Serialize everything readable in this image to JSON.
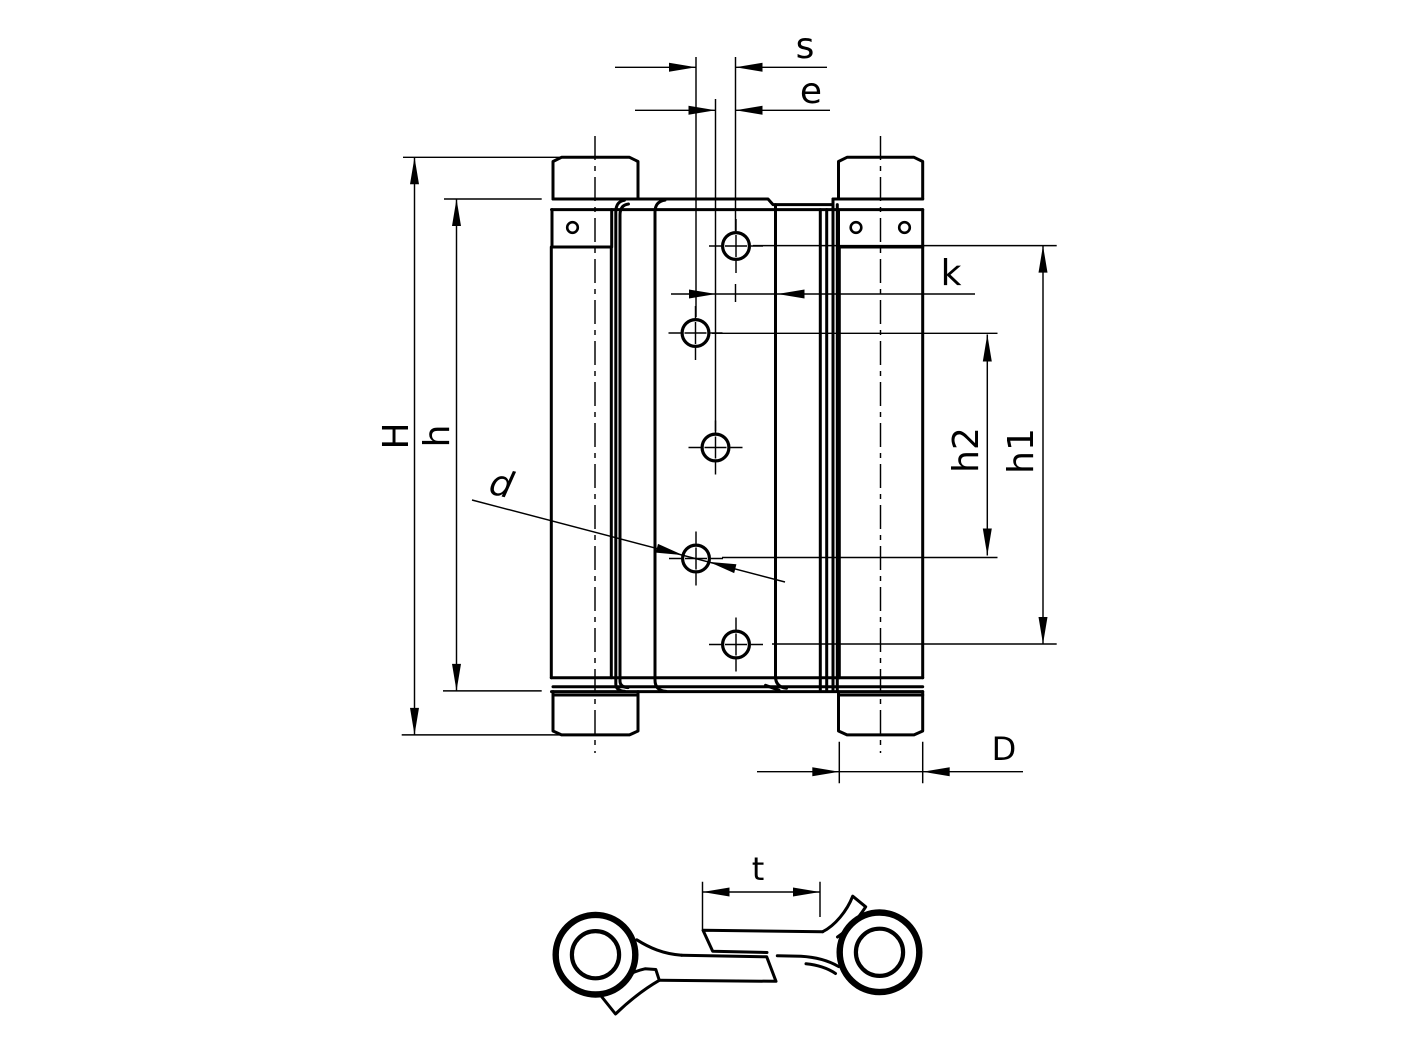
{
  "drawing": {
    "background": "#ffffff",
    "line_color": "#000000",
    "dims": {
      "s": "s",
      "e": "e",
      "k": "k",
      "H": "H",
      "h": "h",
      "h1": "h1",
      "h2": "h2",
      "d": "d",
      "D": "D",
      "t": "t"
    }
  }
}
